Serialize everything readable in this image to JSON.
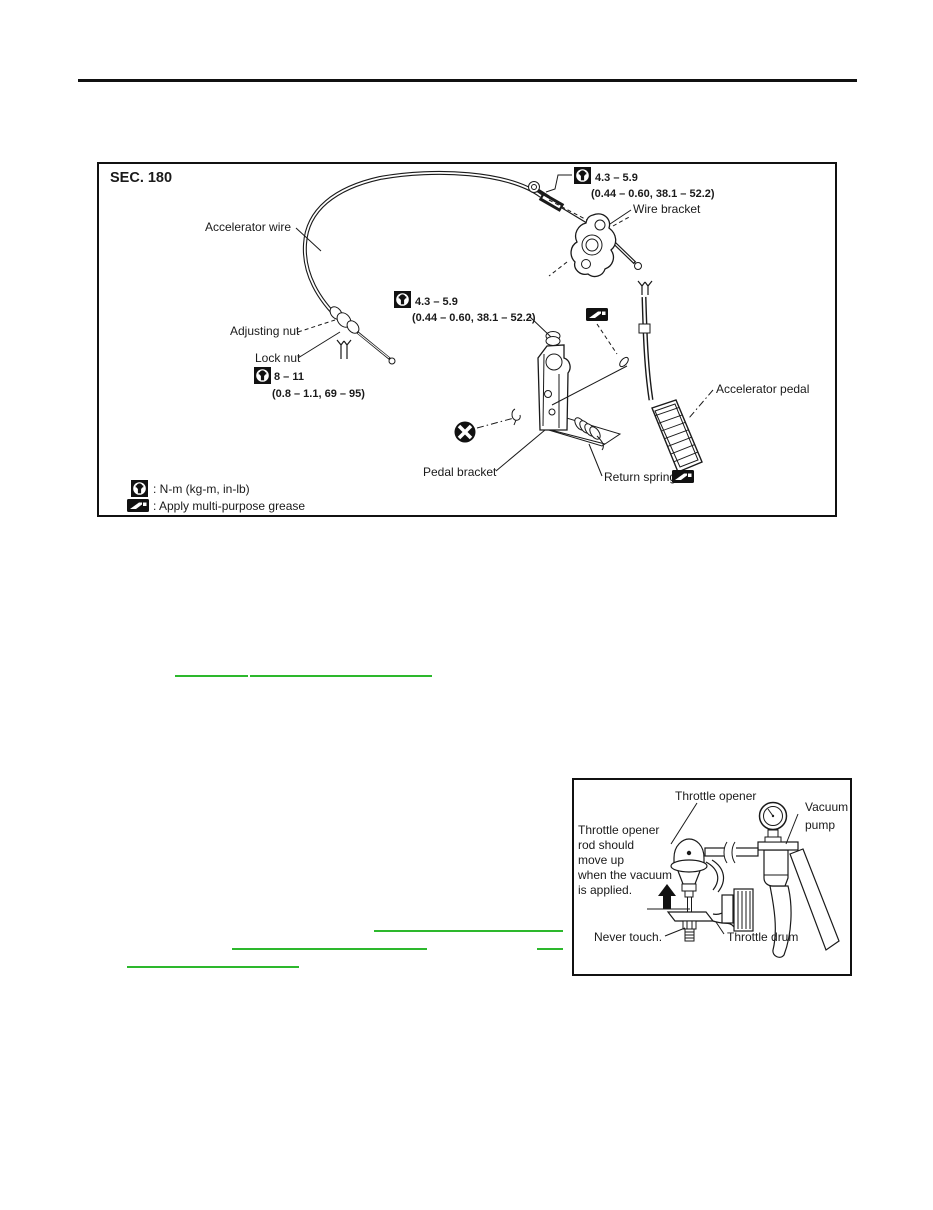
{
  "colors": {
    "ink": "#1a1a1a",
    "link_green": "#2db82d",
    "rule_black": "#111111"
  },
  "figure1": {
    "section": "SEC. 180",
    "labels": {
      "accelerator_wire": "Accelerator wire",
      "wire_bracket": "Wire bracket",
      "adjusting_nut": "Adjusting nut",
      "lock_nut": "Lock nut",
      "pedal_bracket": "Pedal bracket",
      "return_spring": "Return spring",
      "accelerator_pedal": "Accelerator pedal"
    },
    "torque_wire_bracket": {
      "nm": "4.3 – 5.9",
      "alt": "(0.44 – 0.60, 38.1 – 52.2)"
    },
    "torque_pedal_nut": {
      "nm": "4.3 – 5.9",
      "alt": "(0.44 – 0.60, 38.1 – 52.2)"
    },
    "torque_lock_nut": {
      "nm": "8 – 11",
      "alt": "(0.8 – 1.1, 69 – 95)"
    },
    "legend": {
      "torque_meaning": ": N-m (kg-m, in-lb)",
      "grease_meaning": ": Apply multi-purpose grease"
    }
  },
  "figure2": {
    "labels": {
      "throttle_opener": "Throttle opener",
      "vacuum_line1": "Vacuum",
      "vacuum_line2": "pump",
      "never_touch": "Never touch.",
      "throttle_drum": "Throttle drum"
    },
    "note_lines": [
      "Throttle opener",
      "rod should",
      "move up",
      "when the vacuum",
      "is applied."
    ]
  }
}
